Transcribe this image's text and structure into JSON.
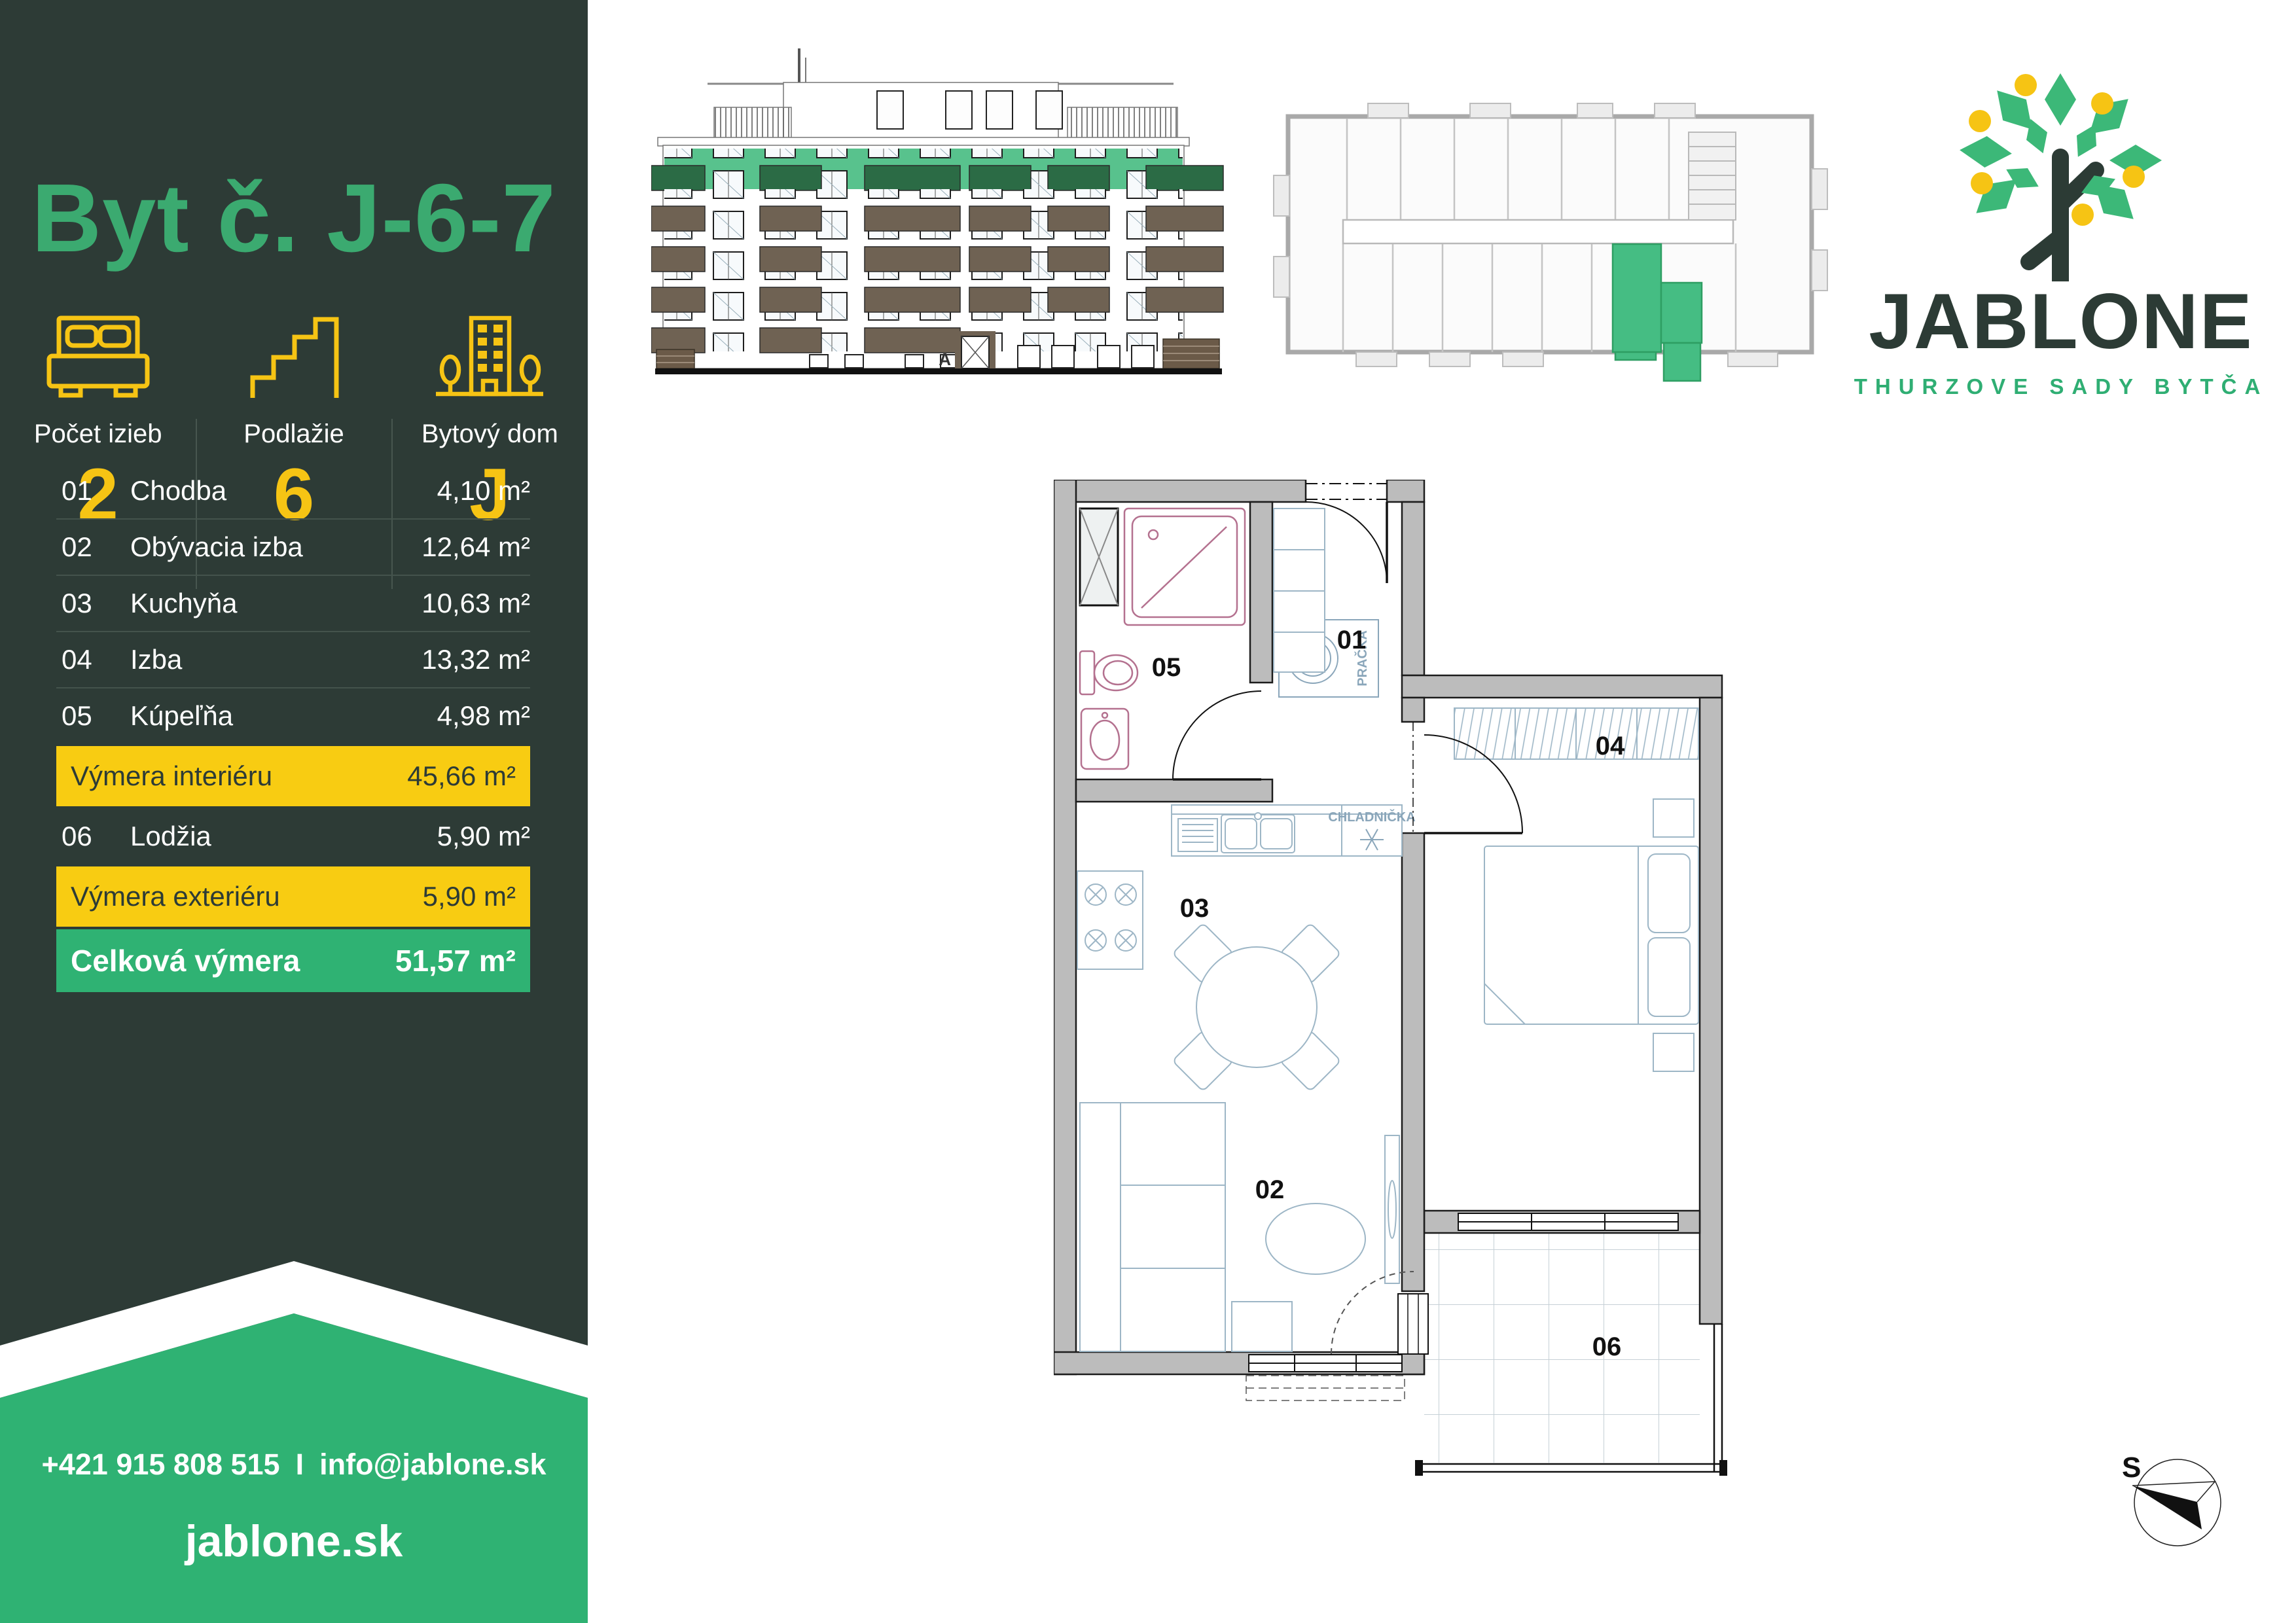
{
  "sidebar": {
    "title": "Byt č. J-6-7",
    "stats": [
      {
        "label": "Počet izieb",
        "value": "2",
        "icon": "bed-icon"
      },
      {
        "label": "Podlažie",
        "value": "6",
        "icon": "stairs-icon"
      },
      {
        "label": "Bytový dom",
        "value": "J",
        "icon": "building-icon"
      }
    ],
    "rooms": [
      {
        "num": "01",
        "name": "Chodba",
        "area": "4,10 m²"
      },
      {
        "num": "02",
        "name": "Obývacia izba",
        "area": "12,64 m²"
      },
      {
        "num": "03",
        "name": "Kuchyňa",
        "area": "10,63 m²"
      },
      {
        "num": "04",
        "name": "Izba",
        "area": "13,32 m²"
      },
      {
        "num": "05",
        "name": "Kúpeľňa",
        "area": "4,98 m²"
      }
    ],
    "summary": {
      "interior": {
        "label": "Výmera interiéru",
        "area": "45,66 m²"
      },
      "loggia": {
        "num": "06",
        "name": "Lodžia",
        "area": "5,90 m²"
      },
      "exterior": {
        "label": "Výmera exteriéru",
        "area": "5,90 m²"
      },
      "total": {
        "label": "Celková výmera",
        "area": "51,57 m²"
      }
    },
    "contact": {
      "phone": "+421 915 808 515",
      "separator": "I",
      "email": "info@jablone.sk",
      "website": "jablone.sk"
    }
  },
  "logo": {
    "name": "JABLONE",
    "subtitle": "THURZOVE SADY BYTČA"
  },
  "elevation": {
    "entrance_label": "A"
  },
  "plan": {
    "labels": {
      "hallway": "01",
      "living_room": "02",
      "kitchen": "03",
      "room": "04",
      "bathroom": "05",
      "loggia": "06"
    },
    "washer_label": "PRAČKA",
    "fridge_label": "CHLADNIČKA"
  },
  "compass": {
    "label": "S"
  },
  "colors": {
    "sidebar_bg": "#2D3B36",
    "title_green": "#3BAA70",
    "accent_yellow": "#F8CC12",
    "accent_green": "#2FB273",
    "elevation_highlight_green": "#58C28D",
    "unit_highlight_green": "#45BD83",
    "balcony_brown": "#6F6253",
    "wall_gray": "#BCBCBC"
  }
}
